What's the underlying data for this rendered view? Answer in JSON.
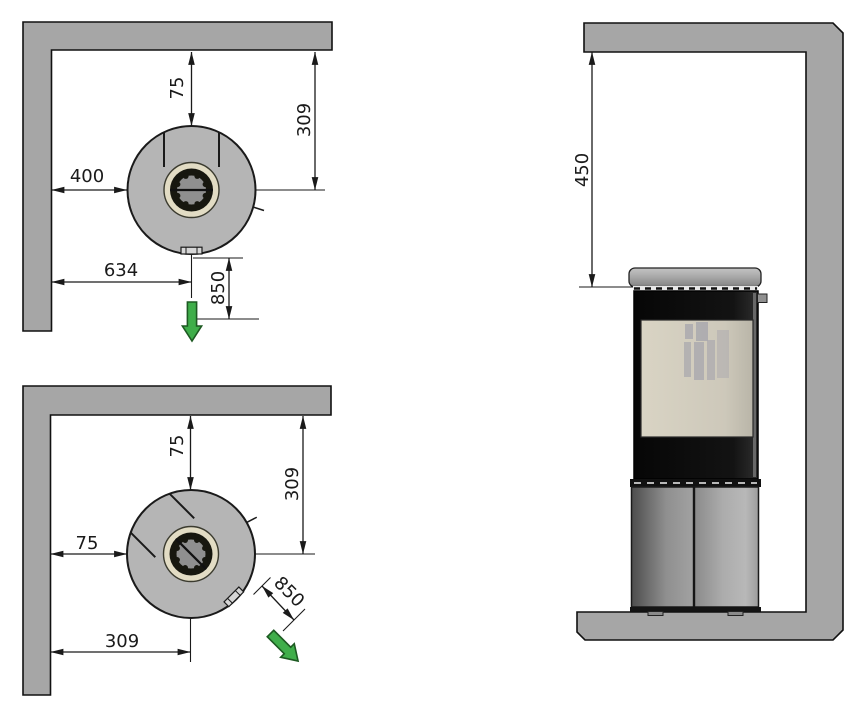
{
  "title": "Stove corner installation clearance diagram",
  "colors": {
    "wall": "#a6a6a6",
    "stove_top_view": "#b5b5b5",
    "line": "#1a1a1a",
    "collar_ring": "#e2dcc4",
    "collar_dark": "#17170f",
    "collar_inner": "#8f8f8f",
    "glass": "#d9d4c4",
    "arrow_green": "#3fae4a",
    "arrow_green_dark": "#1d5a22"
  },
  "diagrams": {
    "corner_straight": {
      "name": "top view - stove facing straight out",
      "clearances": {
        "rear_wall_gap": "75",
        "rear_wall_to_center": "309",
        "side_wall_gap": "400",
        "side_wall_to_center": "634",
        "front_clearance": "850"
      }
    },
    "corner_rotated": {
      "name": "top view - stove rotated 45 degrees",
      "clearances": {
        "rear_wall_gap": "75",
        "rear_wall_to_center": "309",
        "side_wall_gap": "75",
        "side_wall_to_center": "309",
        "front_clearance": "850"
      }
    },
    "front_view": {
      "name": "front view - stove below shelf",
      "clearances": {
        "shelf_to_stove_top": "450"
      }
    }
  }
}
